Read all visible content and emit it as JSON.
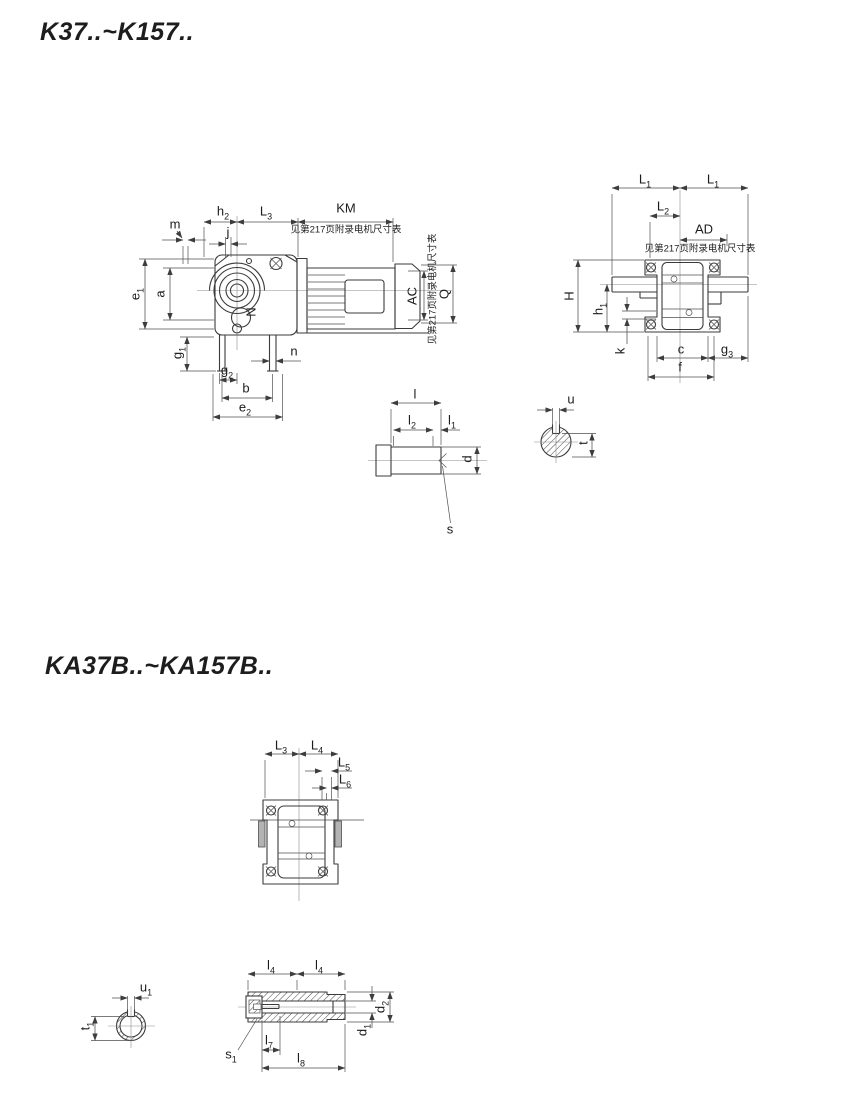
{
  "section1": {
    "title": "K37..~K157..",
    "motor_note": "见第217页附录电机尺寸表",
    "side_view": {
      "m": {
        "base": "m",
        "sub": ""
      },
      "h2": {
        "base": "h",
        "sub": "2"
      },
      "j": {
        "base": "j",
        "sub": ""
      },
      "L3": {
        "base": "L",
        "sub": "3"
      },
      "KM": {
        "base": "KM",
        "sub": ""
      },
      "e1": {
        "base": "e",
        "sub": "1"
      },
      "a": {
        "base": "a",
        "sub": ""
      },
      "N": {
        "base": "N",
        "sub": ""
      },
      "g1": {
        "base": "g",
        "sub": "1"
      },
      "g2": {
        "base": "g",
        "sub": "2"
      },
      "n": {
        "base": "n",
        "sub": ""
      },
      "b": {
        "base": "b",
        "sub": ""
      },
      "e2": {
        "base": "e",
        "sub": "2"
      },
      "AC": {
        "base": "AC",
        "sub": ""
      },
      "Q": {
        "base": "Q",
        "sub": ""
      }
    },
    "end_view": {
      "L1_left": {
        "base": "L",
        "sub": "1"
      },
      "L1_right": {
        "base": "L",
        "sub": "1"
      },
      "L2": {
        "base": "L",
        "sub": "2"
      },
      "AD": {
        "base": "AD",
        "sub": ""
      },
      "H": {
        "base": "H",
        "sub": ""
      },
      "h1": {
        "base": "h",
        "sub": "1"
      },
      "k": {
        "base": "k",
        "sub": ""
      },
      "c": {
        "base": "c",
        "sub": ""
      },
      "g3": {
        "base": "g",
        "sub": "3"
      },
      "f": {
        "base": "f",
        "sub": ""
      }
    },
    "shaft_detail": {
      "l": {
        "base": "l",
        "sub": ""
      },
      "l2": {
        "base": "l",
        "sub": "2"
      },
      "l1": {
        "base": "l",
        "sub": "1"
      },
      "d": {
        "base": "d",
        "sub": ""
      },
      "s": {
        "base": "s",
        "sub": ""
      }
    },
    "shaft_section": {
      "u": {
        "base": "u",
        "sub": ""
      },
      "t": {
        "base": "t",
        "sub": ""
      }
    }
  },
  "section2": {
    "title": "KA37B..~KA157B..",
    "top_view": {
      "L3": {
        "base": "L",
        "sub": "3"
      },
      "L4": {
        "base": "L",
        "sub": "4"
      },
      "L5": {
        "base": "L",
        "sub": "5"
      },
      "L6": {
        "base": "L",
        "sub": "6"
      }
    },
    "hollow_shaft": {
      "l4_left": {
        "base": "l",
        "sub": "4"
      },
      "l4_right": {
        "base": "l",
        "sub": "4"
      },
      "d2": {
        "base": "d",
        "sub": "2"
      },
      "d1": {
        "base": "d",
        "sub": "1"
      },
      "s1": {
        "base": "s",
        "sub": "1"
      },
      "l7": {
        "base": "l",
        "sub": "7"
      },
      "l8": {
        "base": "l",
        "sub": "8"
      }
    },
    "hollow_section": {
      "u1": {
        "base": "u",
        "sub": "1"
      },
      "t1": {
        "base": "t",
        "sub": "1"
      }
    }
  }
}
